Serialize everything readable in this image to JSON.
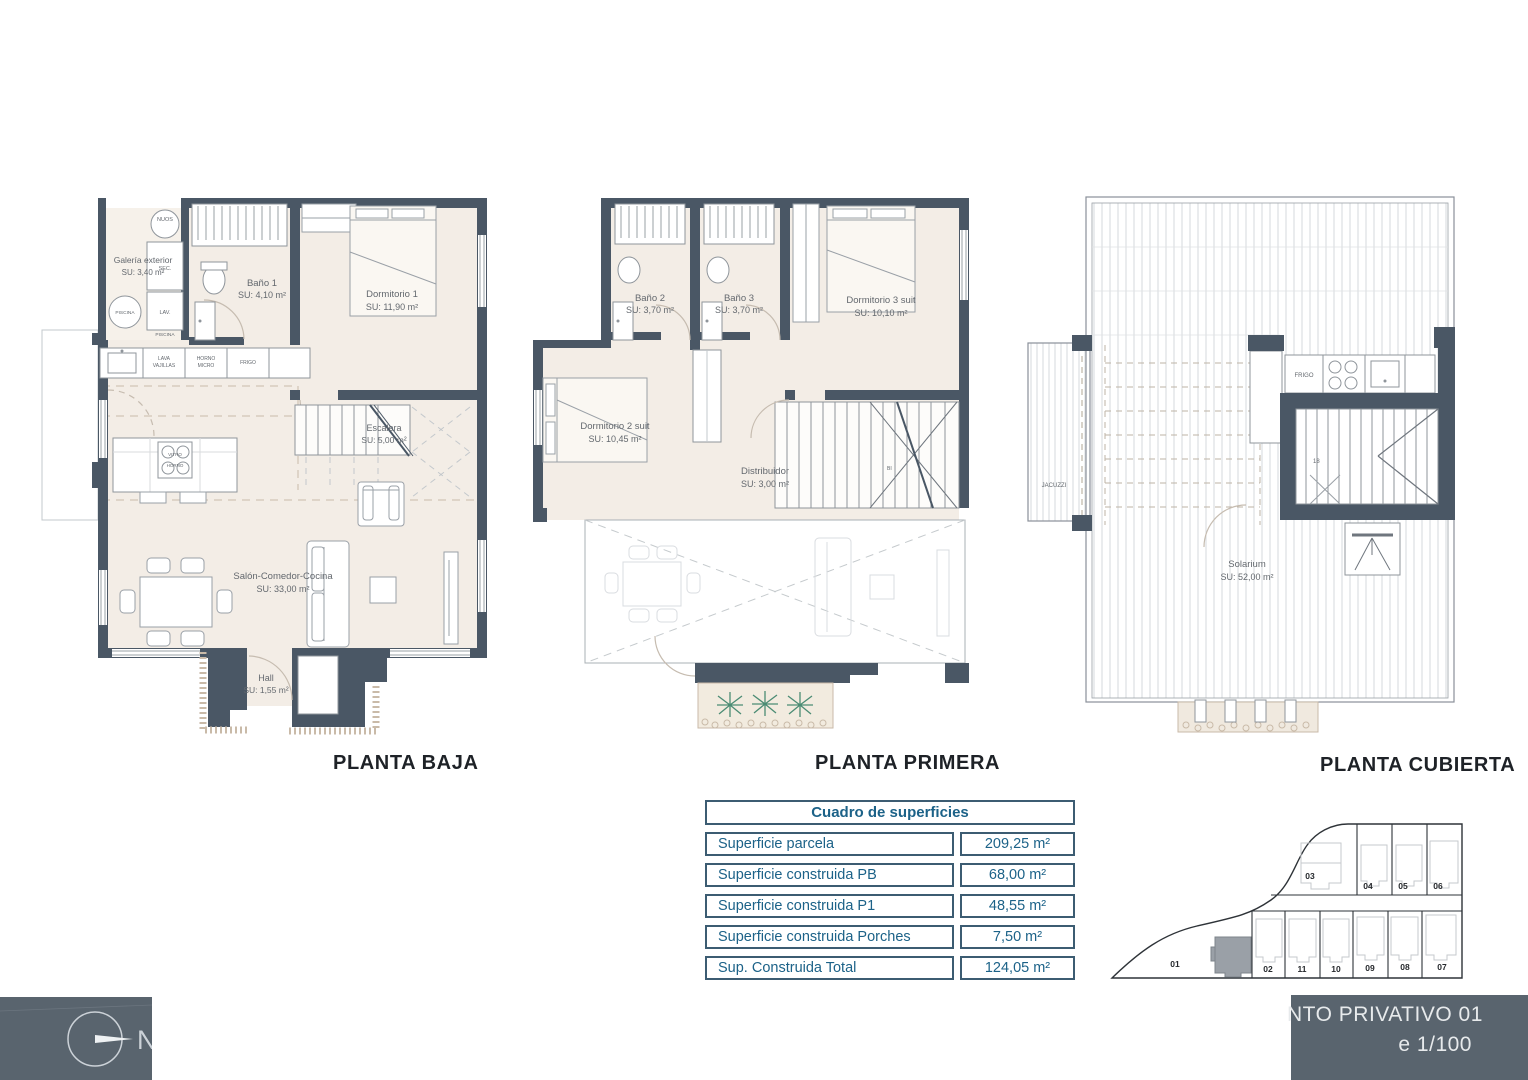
{
  "colors": {
    "wall": "#4a5765",
    "floor": "#f3ede6",
    "table_text": "#1c6288",
    "panel": "#59646e"
  },
  "plans": {
    "baja": {
      "title": "PLANTA BAJA",
      "rooms": {
        "galeria": {
          "name": "Galería exterior",
          "area": "SU: 3,40 m²"
        },
        "bano1": {
          "name": "Baño 1",
          "area": "SU: 4,10 m²"
        },
        "dormitorio1": {
          "name": "Dormitorio 1",
          "area": "SU: 11,90 m²"
        },
        "escalera": {
          "name": "Escalera",
          "area": "SU: 5,00 m²"
        },
        "salon": {
          "name": "Salón-Comedor-Cocina",
          "area": "SU: 33,00 m²"
        },
        "hall": {
          "name": "Hall",
          "area": "SU: 1,55 m²"
        }
      },
      "labels": {
        "nuos": "NUOS",
        "sec": "SEC.",
        "lav": "LAV.",
        "piscina_a": "PISCINA",
        "piscina_b": "PISCINA",
        "lava": "LAVA",
        "vajillas": "VAJILLAS",
        "horno": "HORNO",
        "micro": "MICRO",
        "frigo": "FRIGO",
        "vitro": "VITRO",
        "vitro2": "HORNO"
      }
    },
    "primera": {
      "title": "PLANTA PRIMERA",
      "rooms": {
        "bano2": {
          "name": "Baño 2",
          "area": "SU: 3,70 m²"
        },
        "bano3": {
          "name": "Baño 3",
          "area": "SU: 3,70 m²"
        },
        "dormitorio3": {
          "name": "Dormitorio 3 suit",
          "area": "SU: 10,10 m²"
        },
        "dormitorio2": {
          "name": "Dormitorio 2 suit",
          "area": "SU: 10,45 m²"
        },
        "distribuidor": {
          "name": "Distribuidor",
          "area": "SU: 3,00 m²"
        }
      }
    },
    "cubierta": {
      "title": "PLANTA CUBIERTA",
      "rooms": {
        "solarium": {
          "name": "Solarium",
          "area": "SU: 52,00 m²"
        }
      },
      "labels": {
        "jacuzzi": "JACUZZI",
        "frigo": "FRIGO",
        "step": "18"
      }
    }
  },
  "surface_table": {
    "title": "Cuadro de superficies",
    "rows": [
      {
        "label": "Superficie parcela",
        "value": "209,25 m²"
      },
      {
        "label": "Superficie construida PB",
        "value": "68,00 m²"
      },
      {
        "label": "Superficie construida P1",
        "value": "48,55 m²"
      },
      {
        "label": "Superficie construida Porches",
        "value": "7,50 m²"
      },
      {
        "label": "Sup. Construida Total",
        "value": "124,05 m²"
      }
    ]
  },
  "site_plan": {
    "plots": [
      {
        "label": "01"
      },
      {
        "label": "02"
      },
      {
        "label": "03"
      },
      {
        "label": "04"
      },
      {
        "label": "05"
      },
      {
        "label": "06"
      },
      {
        "label": "07"
      },
      {
        "label": "08"
      },
      {
        "label": "09"
      },
      {
        "label": "10"
      },
      {
        "label": "11"
      }
    ]
  },
  "title_block": {
    "line1": "NTO PRIVATIVO 01",
    "line2": "e 1/100"
  },
  "compass": {
    "north": "N"
  }
}
